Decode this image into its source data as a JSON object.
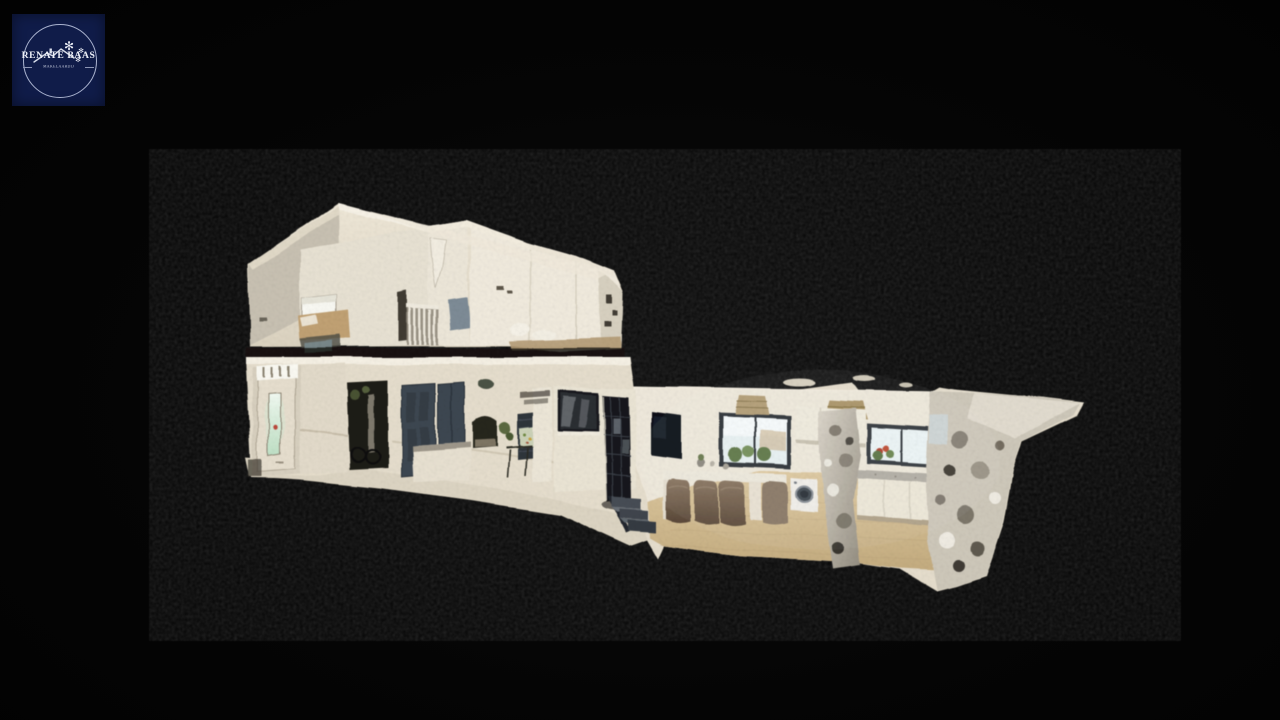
{
  "logo": {
    "brand": "RENATE BAAS",
    "tagline": "MAKELAARDIJ",
    "square_color": "#101c49",
    "ring_color": "#aab3cf",
    "text_color": "#edf0f8"
  },
  "viewer": {
    "background_color": "#050505",
    "model_colors": {
      "wall": "#e7dfcd",
      "bright_wall": "#f0eadd",
      "ceiling_edge": "#f7f2e6",
      "hall_floor": "#ded6c3",
      "wood_floor": "#d5bf94",
      "dark_door": "#3e4751",
      "glazed_door": "#17191d",
      "front_door_glass_glow": "#cfeed6",
      "scan_fragment": "#cfc9bb",
      "dining_chair": "#7d6a55"
    }
  }
}
